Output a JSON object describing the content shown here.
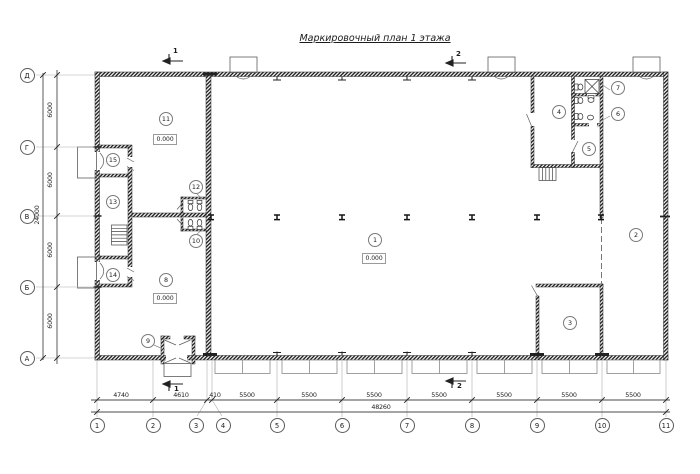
{
  "title": "Маркировочный план 1 этажа",
  "grid": {
    "columns": [
      "1",
      "2",
      "3",
      "4",
      "5",
      "6",
      "7",
      "8",
      "9",
      "10",
      "11"
    ],
    "rows": [
      "Д",
      "Г",
      "В",
      "Б",
      "А"
    ]
  },
  "dimensions": {
    "bottom_segments": [
      "4740",
      "4610",
      "410",
      "5500",
      "5500",
      "5500",
      "5500",
      "5500",
      "5500",
      "5500"
    ],
    "bottom_total": "48260",
    "left_segments": [
      "6000",
      "6000",
      "6000",
      "6000"
    ],
    "left_total": "24000"
  },
  "sections": {
    "cut1": "1",
    "cut2": "2"
  },
  "rooms": [
    {
      "number": "1",
      "elevation": "0.000"
    },
    {
      "number": "2"
    },
    {
      "number": "3"
    },
    {
      "number": "4"
    },
    {
      "number": "5"
    },
    {
      "number": "6"
    },
    {
      "number": "7"
    },
    {
      "number": "8",
      "elevation": "0.000"
    },
    {
      "number": "9"
    },
    {
      "number": "10"
    },
    {
      "number": "11",
      "elevation": "0.000"
    },
    {
      "number": "12"
    },
    {
      "number": "13"
    },
    {
      "number": "14"
    },
    {
      "number": "15"
    }
  ]
}
